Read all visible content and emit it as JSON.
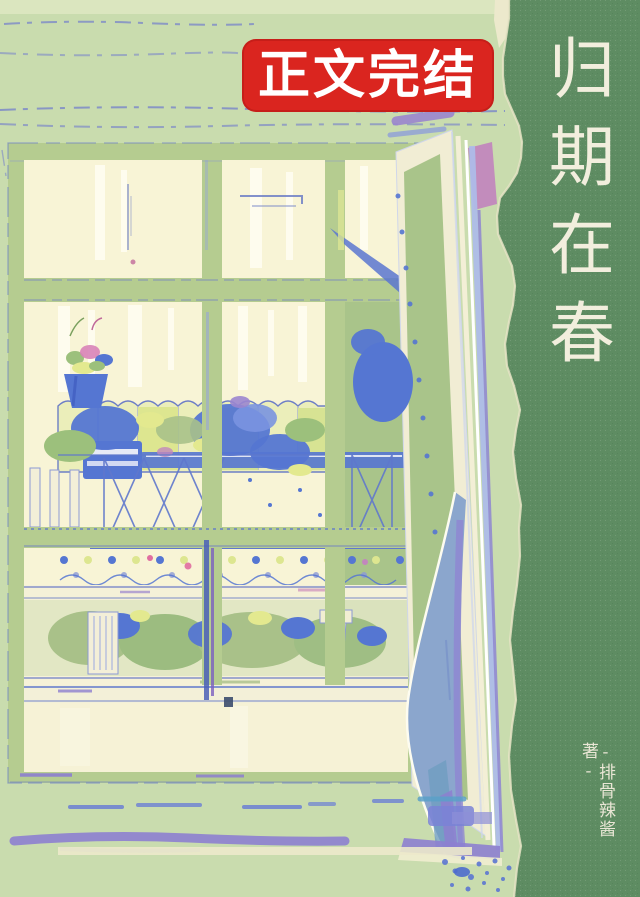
{
  "cover": {
    "badge": {
      "label": "正文完结"
    },
    "title": {
      "text": "归期在春"
    },
    "author": {
      "text": "-排骨辣酱 著-"
    },
    "palette": {
      "wall_green": "#c9dcae",
      "wall_light": "#e0e9c3",
      "frame_green": "#b5cc90",
      "pane_cream": "#f8f4d6",
      "sketch_blue": "#7d89c8",
      "foliage_blue": "#5576d2",
      "foliage_green": "#a9c189",
      "leaf_yellow": "#dde690",
      "glass_green": "#a9c48a",
      "curtain_blue": "#8ba6cd",
      "smudge_purple": "#8d7fd0",
      "accent_pink": "#c287bd",
      "strip_green": "#5e8c62",
      "paper_cream": "#ece9cb",
      "badge_red": "#da251f",
      "badge_text": "#ffffff",
      "title_text": "#f2eedd"
    }
  }
}
